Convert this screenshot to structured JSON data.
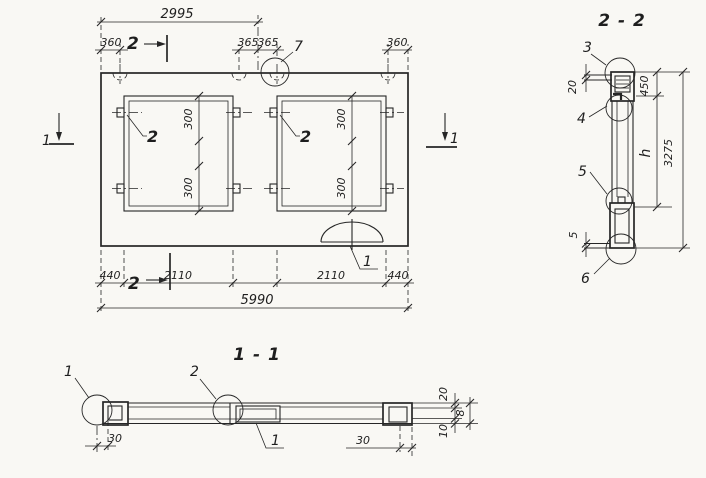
{
  "colors": {
    "ink": "#262626",
    "paper": "#f9f8f4"
  },
  "plan": {
    "markers": {
      "top": "2",
      "bottom": "2",
      "left": "1",
      "right": "1"
    },
    "dims": {
      "half_span": "2995",
      "top_left": "360",
      "top_center_left": "365",
      "top_center_right": "365",
      "top_right": "360",
      "bottom_left": "440",
      "bottom_opening_left": "2110",
      "bottom_opening_right": "2110",
      "bottom_right": "440",
      "overall": "5990",
      "opening_left_top": "300",
      "opening_left_bottom": "300",
      "opening_right_top": "300",
      "opening_right_bottom": "300"
    },
    "callouts": {
      "loop": "7",
      "anchor_left": "2",
      "anchor_right": "2",
      "cutout": "1"
    }
  },
  "section22": {
    "title": "2 - 2",
    "callouts": {
      "c3": "3",
      "c4": "4",
      "c5": "5",
      "c6": "6"
    },
    "dims": {
      "top_flange": "20",
      "sleeve": "450",
      "web": "h",
      "overall": "3275",
      "bottom_gap": "5"
    }
  },
  "section11": {
    "title": "1 - 1",
    "callouts": {
      "left_end": "1",
      "joint": "2",
      "core": "1"
    },
    "dims": {
      "left_offset": "30",
      "right_offset": "30",
      "top_flange": "20",
      "thickness": "8",
      "bottom_flange": "10"
    }
  }
}
